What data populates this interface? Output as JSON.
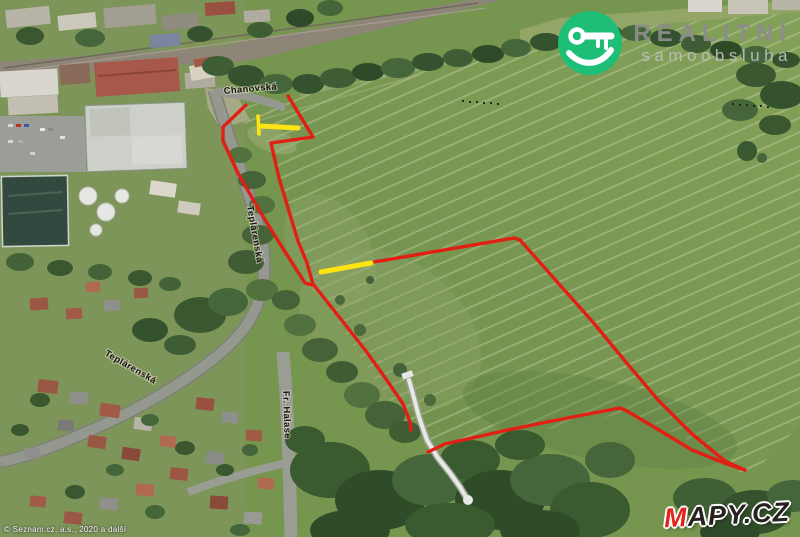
{
  "branding": {
    "watermark": {
      "line1": "REALITNÍ",
      "line2": "samoobsluha",
      "badge_color": "#1fbe77",
      "text_color": "#8d8d8d"
    },
    "map_logo": {
      "prefix": "M",
      "suffix": "APY.CZ",
      "prefix_color": "#e0251a",
      "suffix_color": "#272220"
    },
    "attribution": "© Seznam.cz, a.s., 2020 a další"
  },
  "map": {
    "type": "aerial-3d-photomap",
    "street_labels": [
      {
        "text": "Chanovská"
      },
      {
        "text": "Teplárenská"
      },
      {
        "text": "Teplárenská"
      },
      {
        "text": "Fr. Halase"
      }
    ],
    "overlay": {
      "boundary_color": "#e11f14",
      "access_color": "#ffe414",
      "boundary_style": "solid red outline of offered land parcel",
      "access_style": "yellow access segments"
    }
  }
}
